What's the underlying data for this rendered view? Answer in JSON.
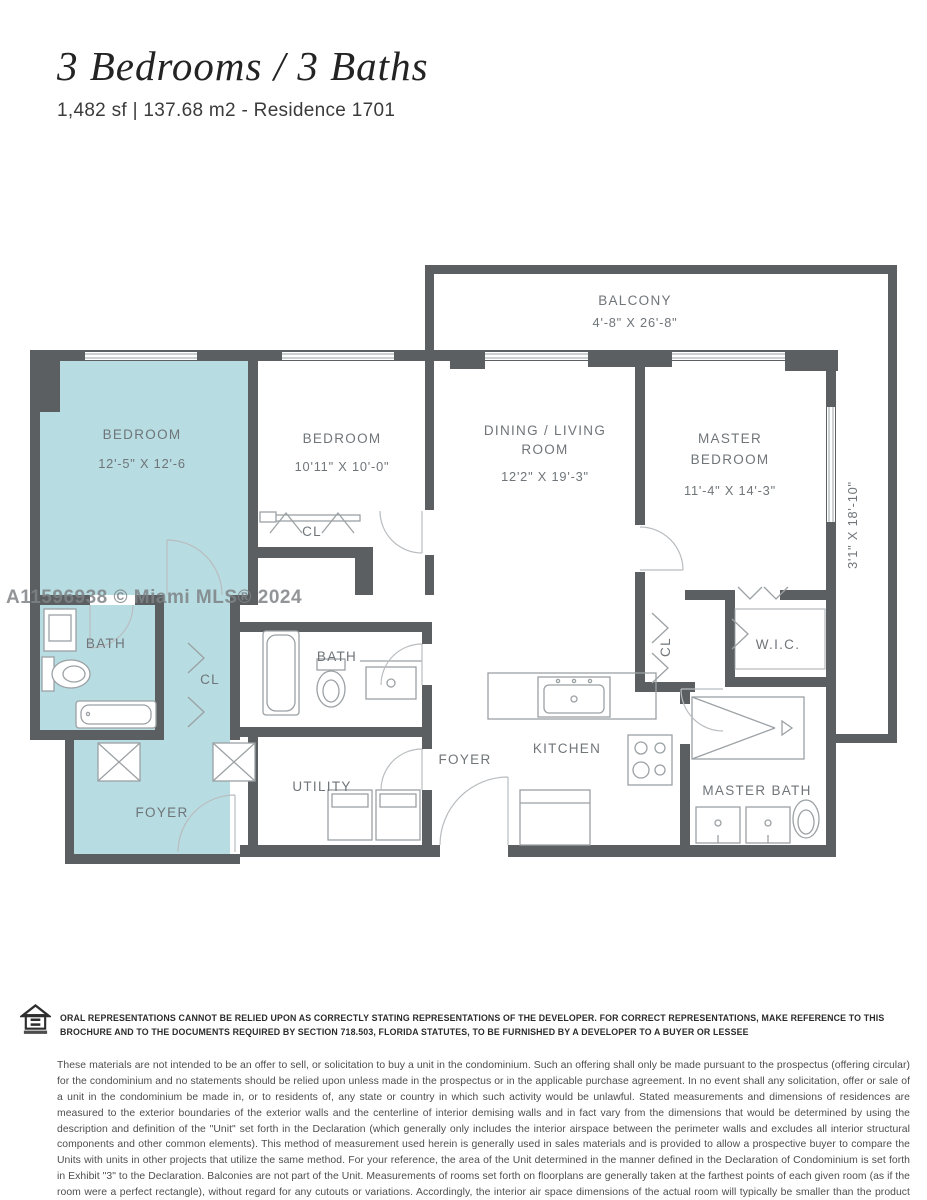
{
  "header": {
    "title": "3 Bedrooms / 3 Baths",
    "subtitle": "1,482 sf | 137.68 m2 - Residence 1701"
  },
  "watermark": "A11596938 © Miami MLS® 2024",
  "plan": {
    "balcony": {
      "label": "BALCONY",
      "dims": "4'-8\" X 26'-8\""
    },
    "side_balcony": {
      "dims": "3'1\" X 18'-10\""
    },
    "bedroom1": {
      "label": "BEDROOM",
      "dims": "12'-5\" X 12'-6"
    },
    "bedroom2": {
      "label": "BEDROOM",
      "dims": "10'11\" X 10'-0\""
    },
    "dining": {
      "line1": "DINING / LIVING",
      "line2": "ROOM",
      "dims": "12'2\" X 19'-3\""
    },
    "master_bedroom": {
      "line1": "MASTER",
      "line2": "BEDROOM",
      "dims": "11'-4\" X 14'-3\""
    },
    "bath1": {
      "label": "BATH"
    },
    "bath2": {
      "label": "BATH"
    },
    "master_bath": {
      "label": "MASTER BATH"
    },
    "cl_corridor": {
      "label": "CL"
    },
    "cl_bedroom2": {
      "label": "CL"
    },
    "cl_master": {
      "label": "CL"
    },
    "wic": {
      "label": "W.I.C."
    },
    "utility": {
      "label": "UTILITY"
    },
    "foyer_unit": {
      "label": "FOYER"
    },
    "foyer_main": {
      "label": "FOYER"
    },
    "kitchen": {
      "label": "KITCHEN"
    }
  },
  "colors": {
    "wall": "#5b5f62",
    "highlight_teal": "#b7dce1",
    "label_gray": "#6f7579"
  },
  "legal": {
    "notice": "ORAL REPRESENTATIONS CANNOT BE RELIED UPON AS CORRECTLY STATING REPRESENTATIONS OF THE DEVELOPER. FOR CORRECT REPRESENTATIONS, MAKE REFERENCE TO THIS BROCHURE AND TO THE DOCUMENTS REQUIRED BY SECTION 718.503, FLORIDA STATUTES, TO BE FURNISHED BY A DEVELOPER TO A BUYER OR LESSEE",
    "disclaimer": "These materials are not intended to be an offer to sell, or solicitation to buy a unit in the condominium. Such an offering shall only be made pursuant to the prospectus (offering circular) for the condominium and no statements should be relied upon unless made in the prospectus or in the applicable purchase agreement. In no event shall any solicitation, offer or sale of a unit in the condominium be made in, or to residents of, any state or country in which such activity would be unlawful. Stated measurements and dimensions of residences are measured to the exterior boundaries of the exterior walls and the centerline of interior demising walls and in fact vary from the dimensions that would be determined by using the description and definition of the \"Unit\" set forth in the Declaration (which generally only includes the interior airspace between the perimeter walls and excludes all interior structural components and other common elements). This method of measurement used herein is generally used in sales materials and is provided to allow a prospective buyer to compare the Units with units in other projects that utilize the same method. For your reference, the area of the Unit determined in the manner defined in the Declaration of Condominium is set forth in Exhibit \"3\" to the Declaration. Balconies are not part of the Unit. Measurements of rooms set forth on floorplans are generally taken at the farthest points of each given room (as if the room were a perfect rectangle), without regard for any cutouts or variations. Accordingly, the interior air space dimensions of the actual room will typically be smaller than the product obtained by multiplying the stated length and width. All measurements and dimensions are estimates. All depictions of appliances, counters, soffits, floor coverings and other matters of detail, including, without limitation, items of finish and decoration, are conceptual only and are not necessarily included in each Unit."
  }
}
